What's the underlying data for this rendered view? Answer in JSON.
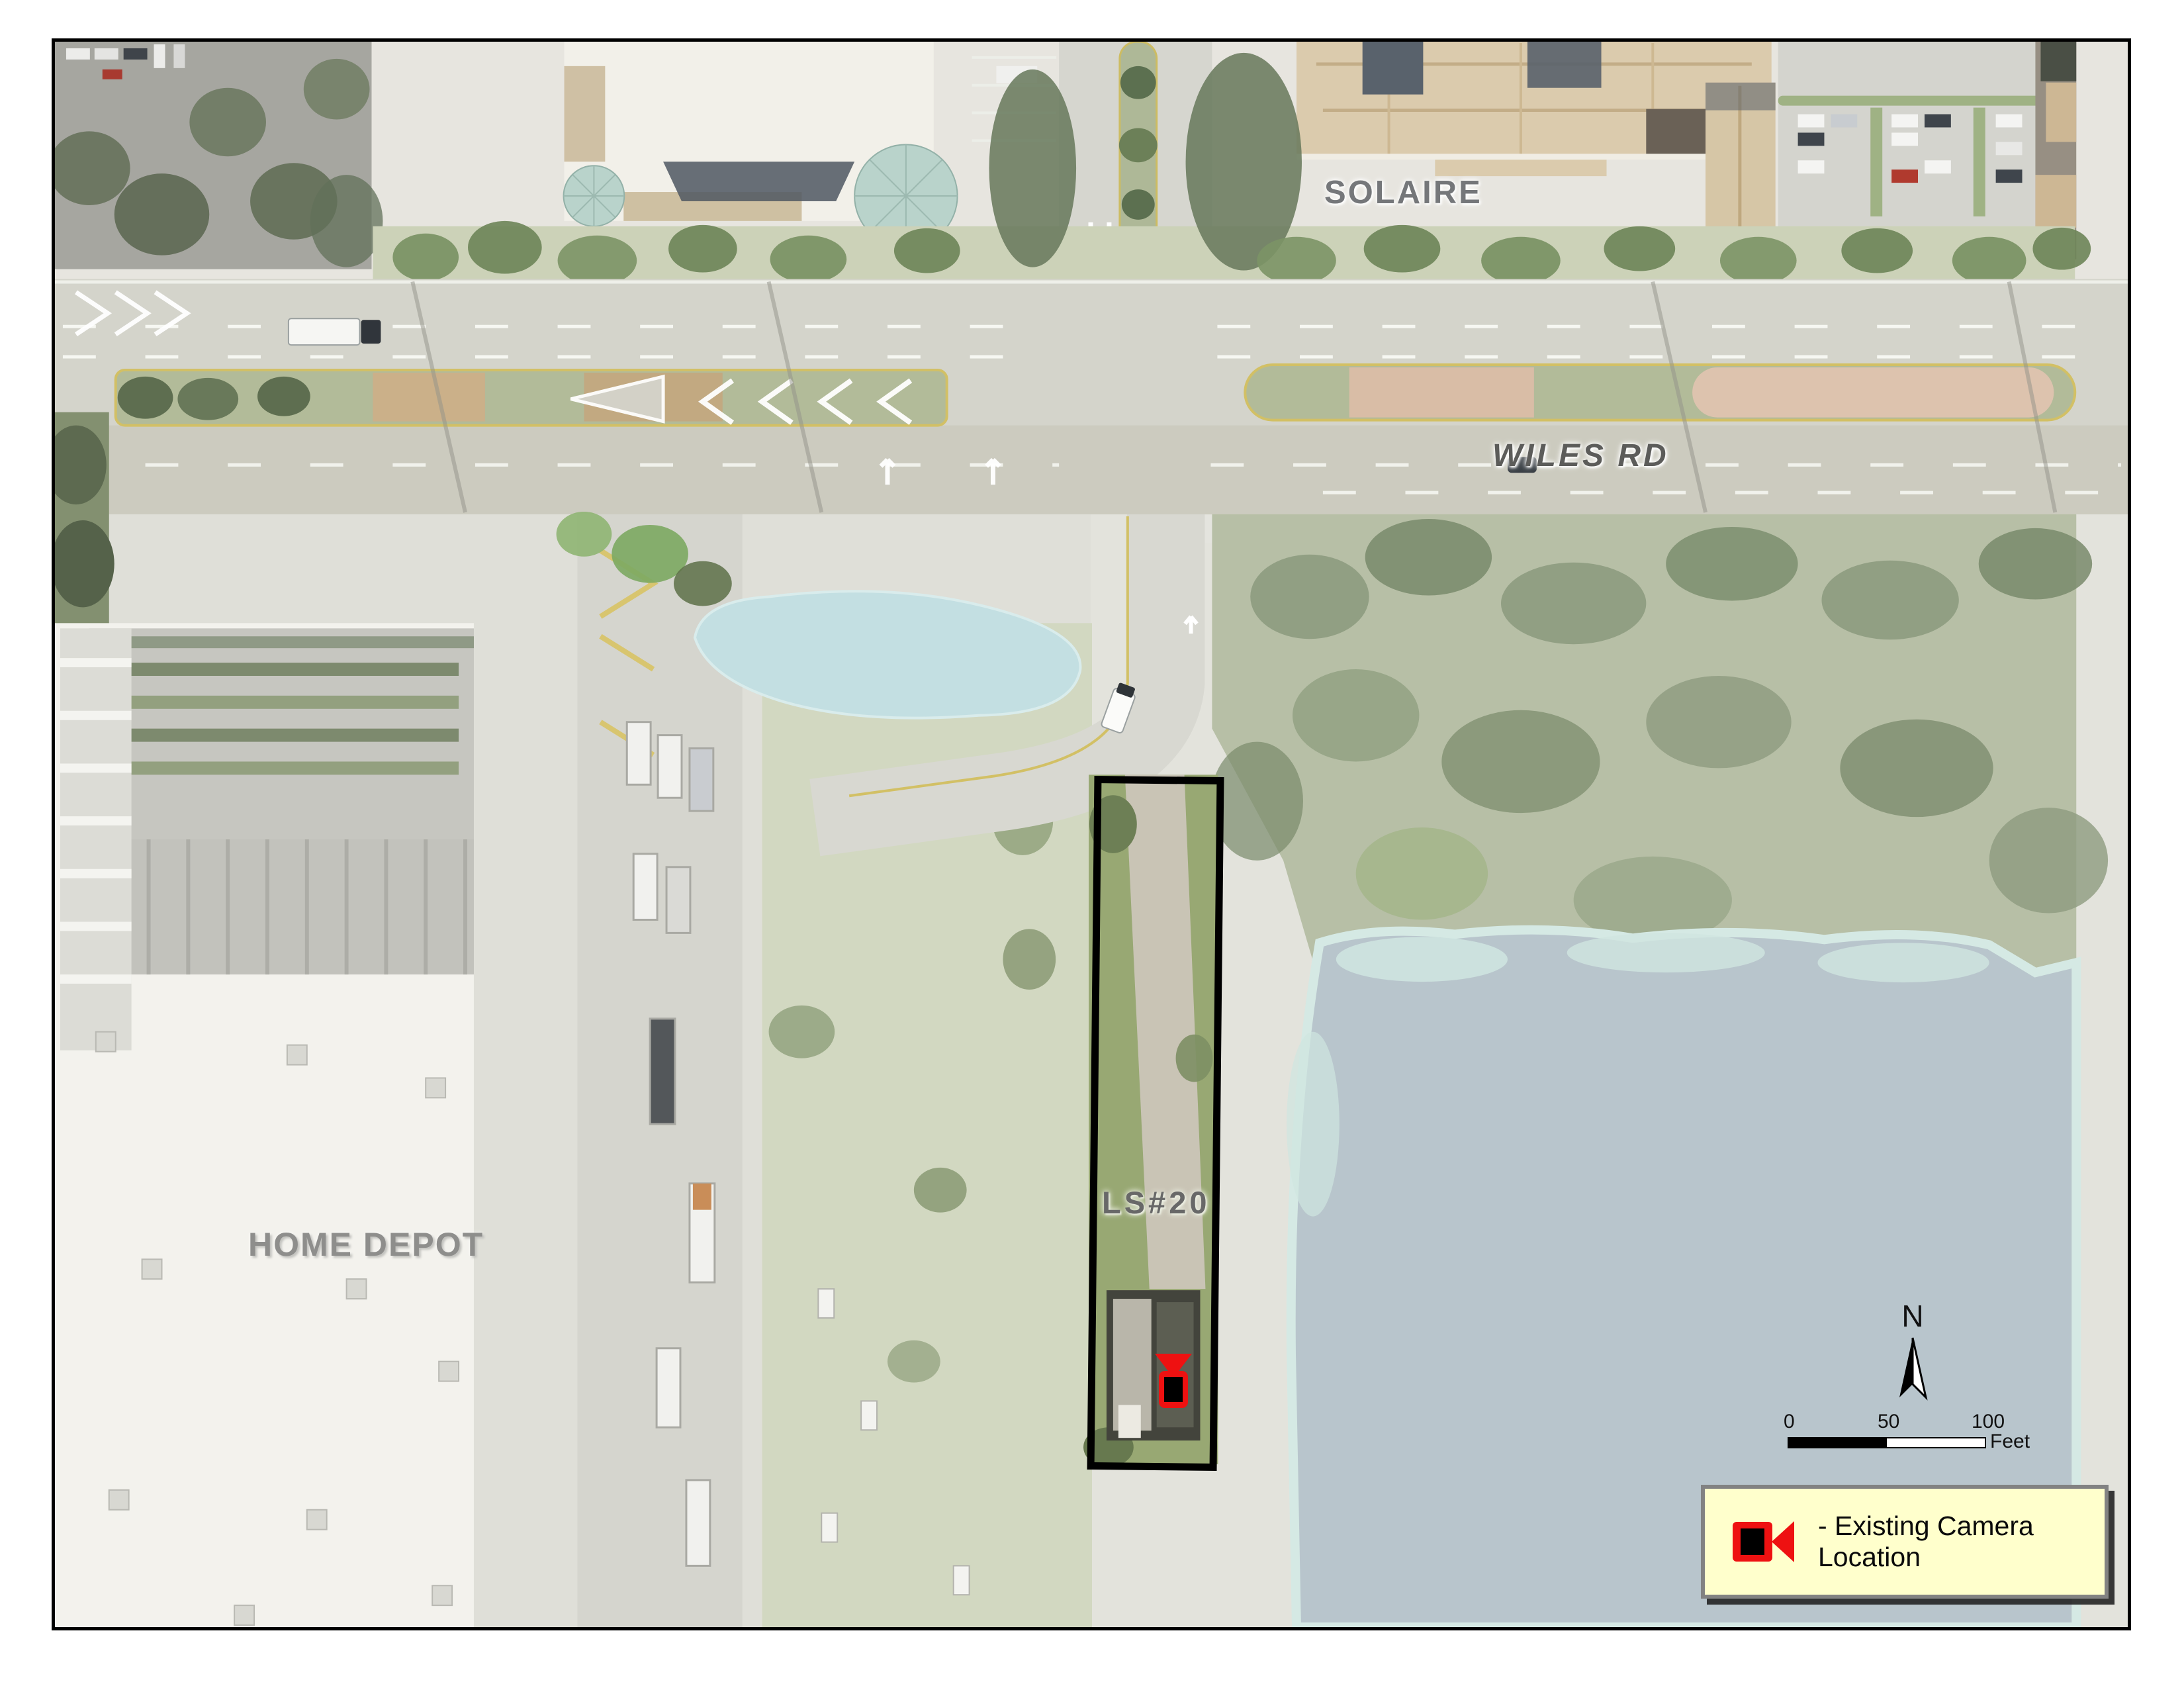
{
  "map": {
    "title": "LS#20 existing camera location aerial map",
    "area_labels": {
      "solaire": "SOLAIRE",
      "wiles_rd": "WILES RD",
      "home_depot": "HOME DEPOT",
      "site": "LS#20"
    },
    "north_arrow": {
      "label": "N"
    },
    "scale_bar": {
      "ticks": [
        "0",
        "50",
        "100"
      ],
      "unit": "Feet"
    },
    "legend": {
      "items": [
        {
          "icon": "camera",
          "label": "- Existing Camera Location"
        }
      ]
    },
    "markers": [
      {
        "type": "existing-camera",
        "at": "LS#20 lift station"
      }
    ],
    "colors": {
      "camera_red": "#ee1111",
      "legend_bg": "#ffffcc",
      "site_outline": "#000000",
      "lake": "#b8c5cc",
      "pond": "#c3dfe2",
      "label_gray": "#6f6f6f"
    }
  }
}
